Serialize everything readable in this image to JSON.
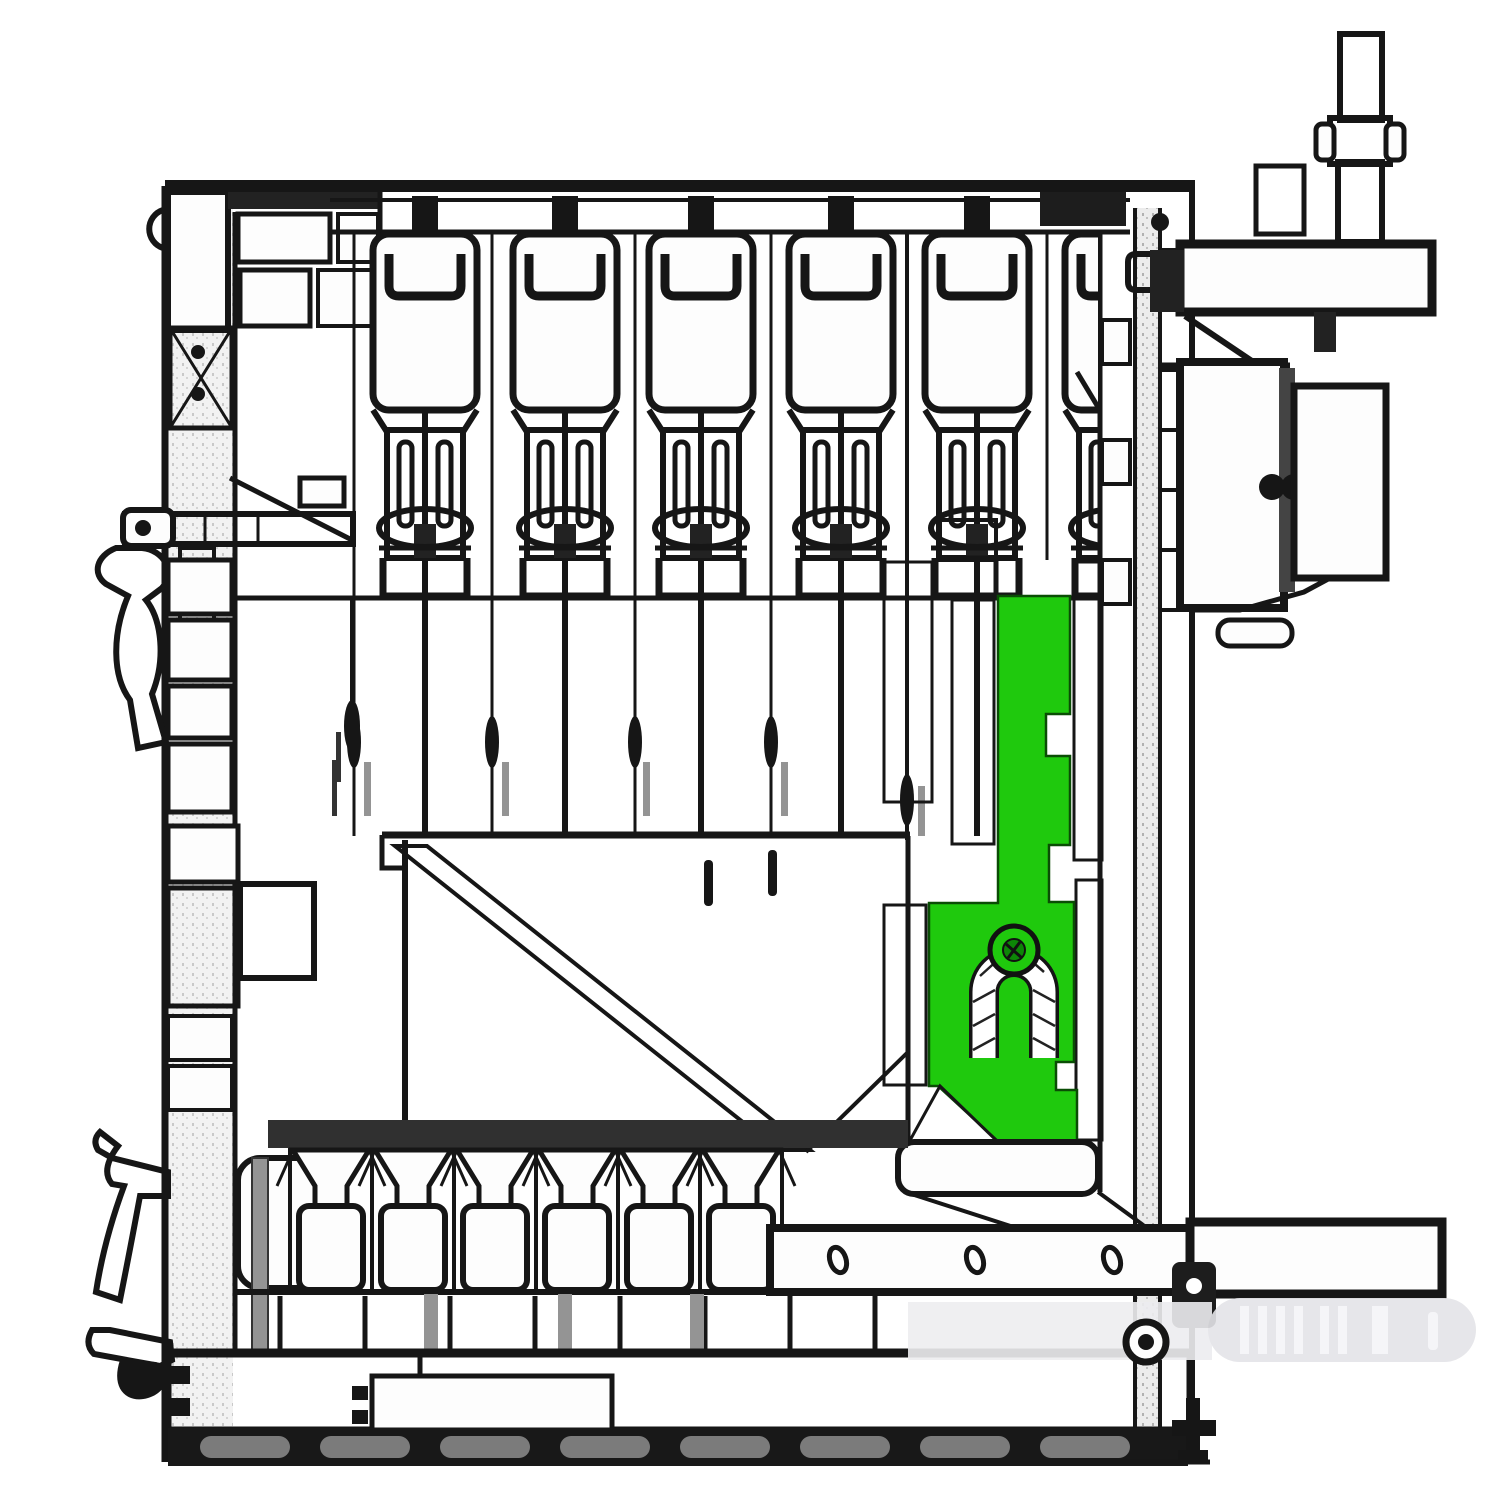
{
  "figure": {
    "kind": "sectional-engineering-drawing",
    "highlight_note": "one internal bracket component is highlighted in green"
  },
  "colors": {
    "background": "#ffffff",
    "ink": "#161616",
    "highlight": "#1fc90d",
    "highlight_dark": "#0d8607",
    "highlight_outline": "#0a4d05",
    "cup_shade": "#b9b9b9",
    "gray_rod": "#949494",
    "band_dark": "#303030",
    "ghost": "#e4e4e8",
    "ghost_left": "#ededf0",
    "ghost_rib": "#f5f5f8",
    "chain_light": "#dddddd"
  }
}
